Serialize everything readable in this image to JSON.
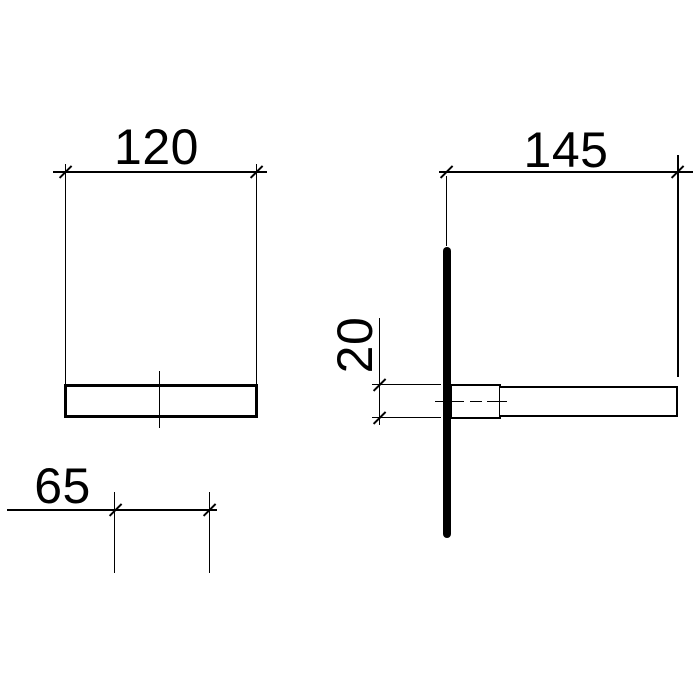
{
  "colors": {
    "background": "#ffffff",
    "line": "#000000"
  },
  "dimensions": {
    "front_width": "120",
    "front_hole_spacing": "65",
    "side_depth": "145",
    "side_thickness": "20"
  }
}
